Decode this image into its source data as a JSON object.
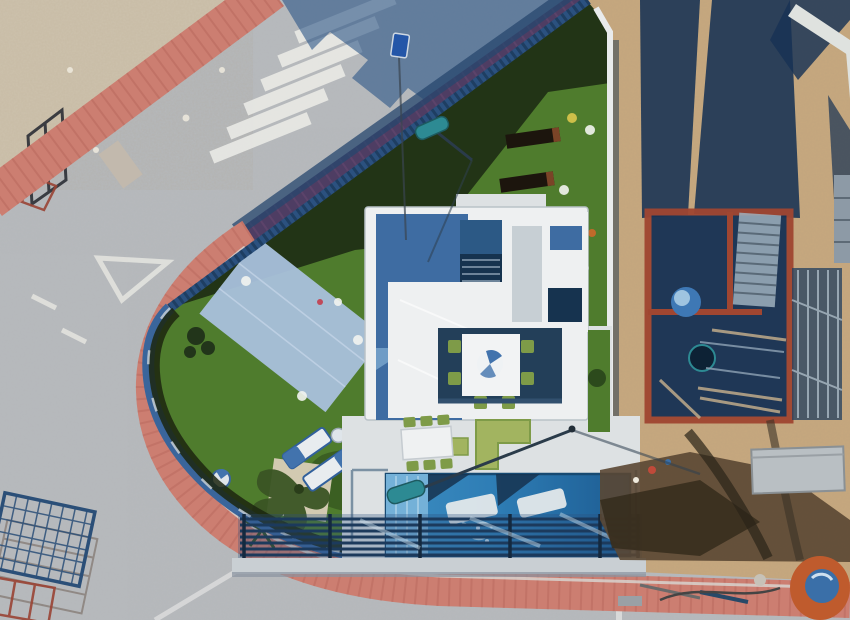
{
  "scene": {
    "type": "aerial-drone-photograph",
    "subject": "modern-villa-with-pool-and-lawn-next-to-construction-site",
    "view": "top-down",
    "objects": [
      "asphalt-road",
      "pedestrian-crosswalk",
      "yield-road-marking",
      "red-tiled-sidewalk",
      "vacant-sandy-lot",
      "wire-fence-posts",
      "artificial-turf-lawn",
      "paved-patio",
      "garden-planters",
      "sun-loungers",
      "parasol",
      "olive-tree",
      "palm-plant",
      "villa-roof-terrace",
      "staircase",
      "pergola",
      "outdoor-dining-table",
      "green-garden-chairs",
      "green-corner-sofa",
      "swimming-pool",
      "in-pool-loungers",
      "slatted-boundary-fence",
      "glass-pool-fence",
      "street-lamp",
      "street-sign",
      "temporary-construction-fence",
      "brick-building-under-construction",
      "scaffolding",
      "building-shadows",
      "excavated-soil",
      "concrete-mixer",
      "block-pallets",
      "boundary-wall"
    ]
  },
  "palette": {
    "road": "#b5b8bb",
    "roadShadow": "#2b5587",
    "sand": "#c7a87e",
    "sandLot": "#cdc2ad",
    "sandShade": "#b3926a",
    "sidewalkRed": "#cc7e71",
    "sidewalkRedDark": "#b96a5e",
    "sidewalkShadow": "#4e3d63",
    "lawn": "#4f7c2d",
    "lawnDark": "#1f2e14",
    "lawnShade": "#2c4a1c",
    "patio": "#a9c1dc",
    "fence": "#2b517f",
    "fenceDark": "#1c3a5c",
    "wallWhite": "#e9ebec",
    "villaWhite": "#eef0f1",
    "terrace": "#dde1e3",
    "roofBlue": "#3e6ca2",
    "roofMid": "#2c5985",
    "roofDark": "#16334f",
    "panel": "#c7cfd4",
    "pool": "#2e7db5",
    "poolLight": "#74b1d8",
    "poolDeep": "#1d5c92",
    "chairGreen": "#7e9b48",
    "sofaGreen": "#a2b460",
    "brick": "#a04631",
    "shadowNavy": "#173254",
    "soil": "#5a4733",
    "soilDark": "#352c1c",
    "mixerOrange": "#bf5b2d",
    "mixerBlue": "#3a6fa8",
    "lampTeal": "#2d8a93",
    "signBlue": "#2456a8",
    "marking": "#e9e9e5",
    "gravel": "#d9cfb8"
  }
}
